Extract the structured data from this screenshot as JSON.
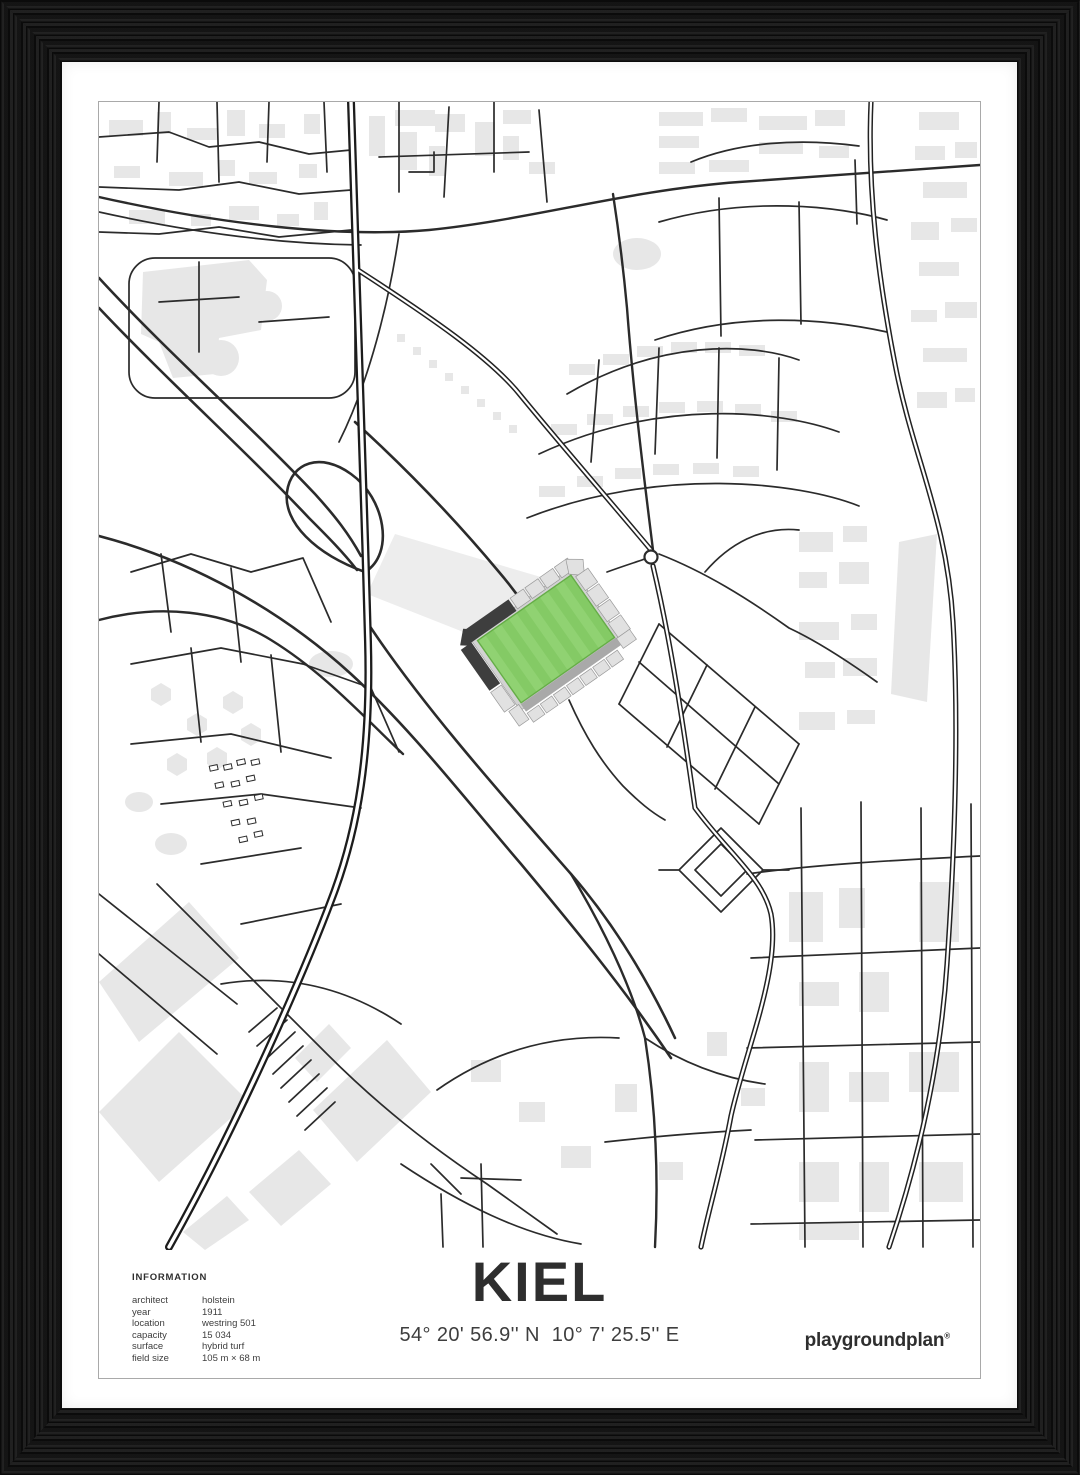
{
  "poster": {
    "caption": {
      "info": {
        "heading": "INFORMATION",
        "rows": [
          {
            "label": "architect",
            "value": "holstein"
          },
          {
            "label": "year",
            "value": "1911"
          },
          {
            "label": "location",
            "value": "westring 501"
          },
          {
            "label": "capacity",
            "value": "15 034"
          },
          {
            "label": "surface",
            "value": "hybrid turf"
          },
          {
            "label": "field size",
            "value": "105 m × 68 m"
          }
        ]
      },
      "title": "KIEL",
      "coordinates": "54° 20' 56.9'' N  10° 7' 25.5'' E",
      "brand": {
        "name": "playgroundplan",
        "mark": "®"
      }
    }
  },
  "colors": {
    "paper": "#ffffff",
    "print_border": "#a9a9a9",
    "map_street": "#2b2b2b",
    "map_building": "#e7e7e7",
    "pitch_green_light": "#90d272",
    "pitch_green_dark": "#84ca65",
    "pitch_outline": "#65ad47",
    "stand_dark": "#3e3e3e",
    "stand_mid": "#a9a9a9",
    "stand_light": "#e1e1e1",
    "text_dark": "#2e2e2e"
  }
}
